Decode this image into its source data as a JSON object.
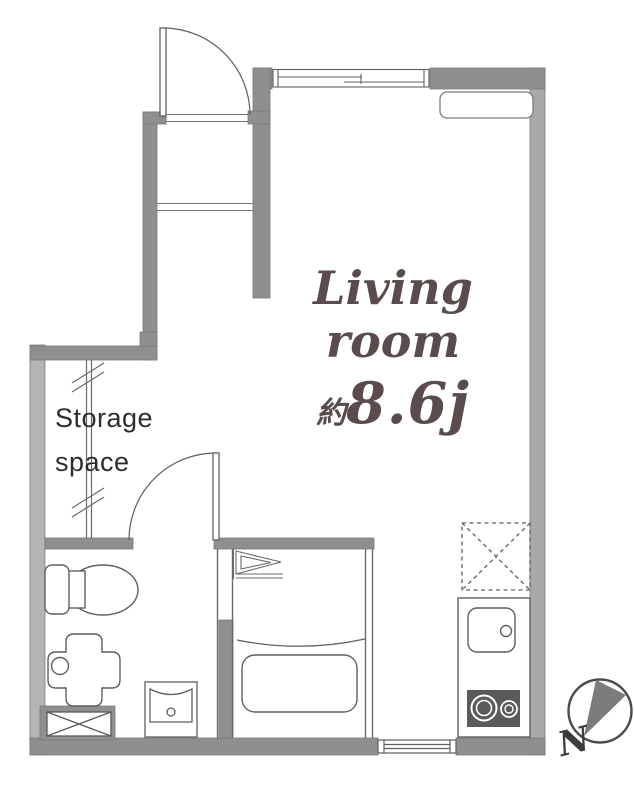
{
  "floorplan": {
    "living_room": {
      "line1": "Living",
      "line2": "room",
      "area_prefix": "約",
      "area_value": "8.6j"
    },
    "storage": {
      "line1": "Storage",
      "line2": "space"
    },
    "compass": {
      "north_label": "N"
    },
    "fixtures": [
      "entrance-door",
      "entry-step",
      "sliding-window",
      "air-conditioner",
      "closet-sliding-door",
      "washroom-door",
      "toilet",
      "utility-basin",
      "washing-machine-pan",
      "washbasin",
      "bathroom-folding-door",
      "bathtub",
      "refrigerator-space",
      "kitchen-counter",
      "kitchen-sink",
      "gas-stove",
      "service-window",
      "compass-rose"
    ],
    "colors": {
      "wall_dark": "#8f8f8f",
      "wall_left": "#b4b4b4",
      "wall_right": "#a9a9a9",
      "fixture_line": "#606060",
      "living_label": "#5a4c4c",
      "storage_text": "#2d2d2d",
      "stove_fill": "#5a5a5a",
      "compass_wedge": "#7c7c7c"
    }
  }
}
